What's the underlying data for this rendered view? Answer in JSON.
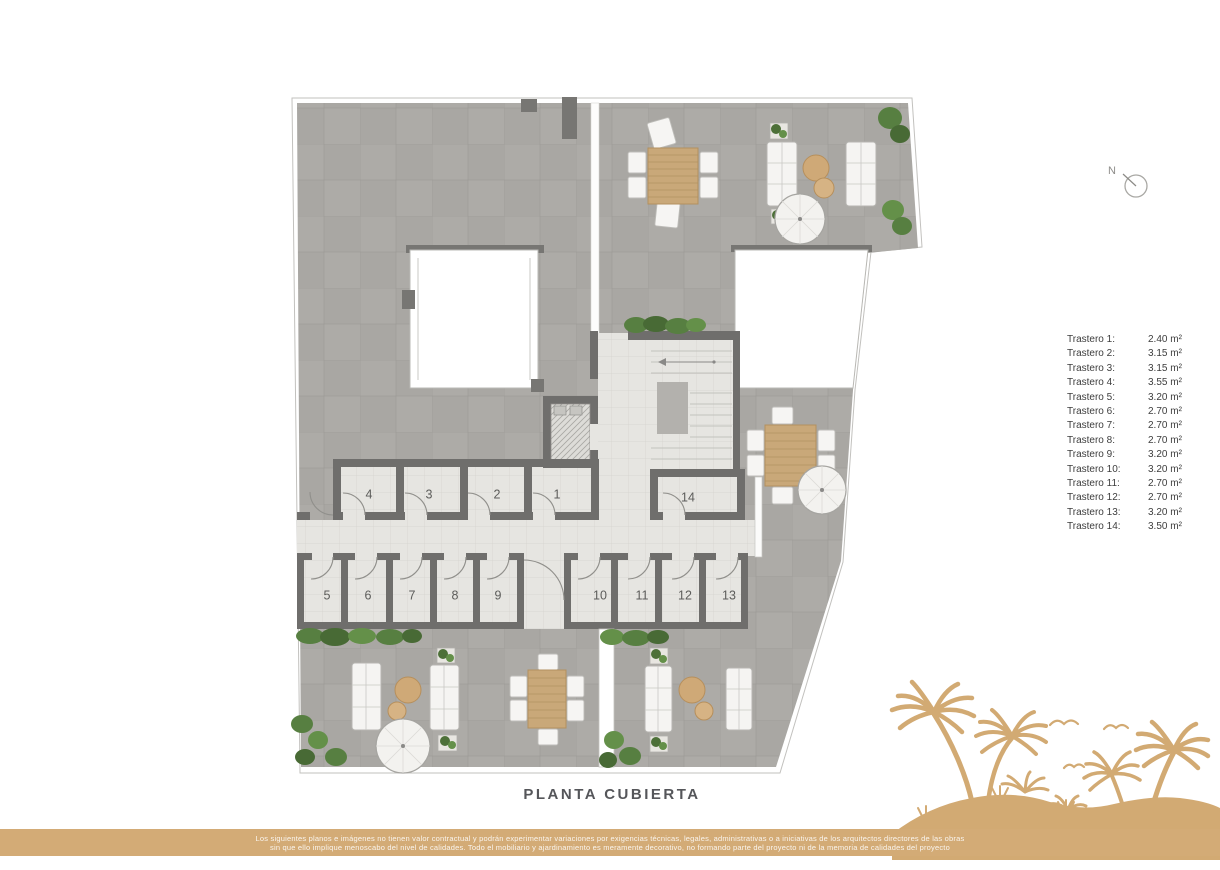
{
  "plan": {
    "title": "PLANTA CUBIERTA",
    "north_label": "N",
    "room_numbers": [
      "1",
      "2",
      "3",
      "4",
      "5",
      "6",
      "7",
      "8",
      "9",
      "10",
      "11",
      "12",
      "13",
      "14"
    ]
  },
  "legend": {
    "items": [
      {
        "label": "Trastero 1:",
        "area": "2.40 m²"
      },
      {
        "label": "Trastero 2:",
        "area": "3.15 m²"
      },
      {
        "label": "Trastero 3:",
        "area": "3.15 m²"
      },
      {
        "label": "Trastero 4:",
        "area": "3.55 m²"
      },
      {
        "label": "Trastero 5:",
        "area": "3.20 m²"
      },
      {
        "label": "Trastero 6:",
        "area": "2.70 m²"
      },
      {
        "label": "Trastero 7:",
        "area": "2.70 m²"
      },
      {
        "label": "Trastero 8:",
        "area": "2.70 m²"
      },
      {
        "label": "Trastero 9:",
        "area": "3.20 m²"
      },
      {
        "label": "Trastero 10:",
        "area": "3.20 m²"
      },
      {
        "label": "Trastero 11:",
        "area": "2.70 m²"
      },
      {
        "label": "Trastero 12:",
        "area": "2.70 m²"
      },
      {
        "label": "Trastero 13:",
        "area": "3.20 m²"
      },
      {
        "label": "Trastero 14:",
        "area": "3.50 m²"
      }
    ]
  },
  "footer": {
    "line1": "Los siguientes planos e imágenes no tienen valor contractual y podrán experimentar variaciones por exigencias técnicas, legales, administrativas o a iniciativas de los arquitectos directores de las obras",
    "line2": "sin que ello implique menoscabo del nivel de calidades. Todo el mobiliario y ajardinamiento es meramente decorativo, no formando parte del proyecto ni de la memoria de calidades del proyecto"
  },
  "colors": {
    "accent_tan": "#d2aa73",
    "footer_bar": "#d3ab76",
    "wall_gray": "#6f6e6c",
    "terrace_gray": "#a9a7a3",
    "light_tile": "#e6e5e1",
    "plant_green": "#55793f"
  }
}
